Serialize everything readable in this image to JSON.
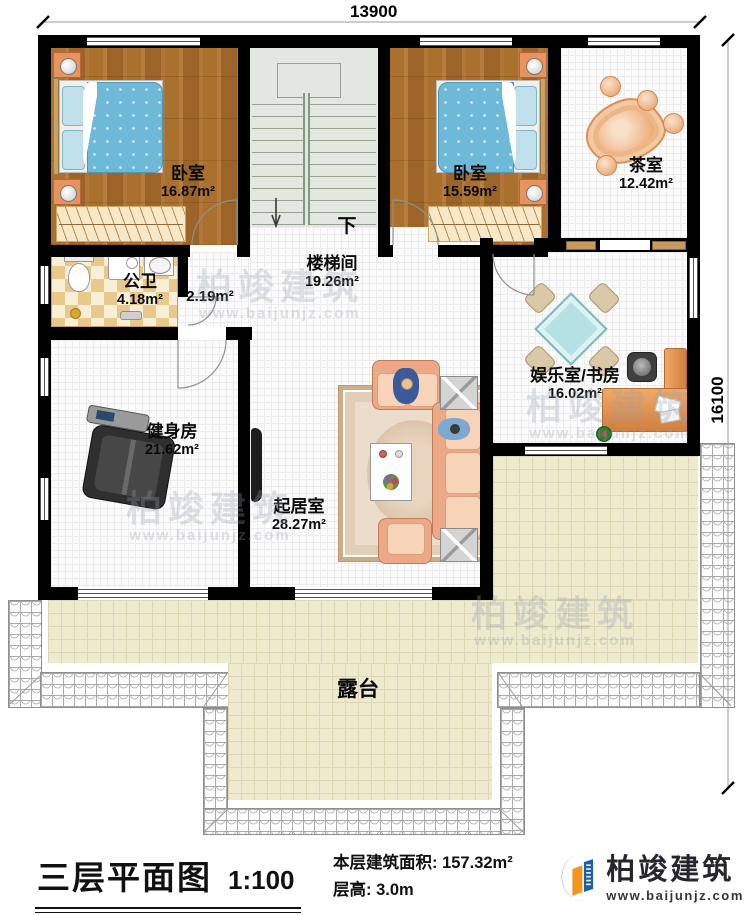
{
  "dimensions": {
    "top_width": "13900",
    "right_height": "16100"
  },
  "rooms": {
    "bedroom_left": {
      "name": "卧室",
      "area": "16.87m²"
    },
    "bedroom_right": {
      "name": "卧室",
      "area": "15.59m²"
    },
    "tea_room": {
      "name": "茶室",
      "area": "12.42m²"
    },
    "bathroom": {
      "name": "公卫",
      "area": "4.18m²"
    },
    "vestibule": {
      "area": "2.19m²"
    },
    "stair_hall": {
      "name": "楼梯间",
      "area": "19.26m²"
    },
    "entertainment_study": {
      "name": "娱乐室/书房",
      "area": "16.02m²"
    },
    "gym": {
      "name": "健身房",
      "area": "21.62m²"
    },
    "living_room": {
      "name": "起居室",
      "area": "28.27m²"
    },
    "terrace": {
      "name": "露台"
    },
    "stairs": {
      "direction_label": "下"
    }
  },
  "watermark": {
    "brand": "柏竣建筑",
    "website": "www.baijunjz.com"
  },
  "footer": {
    "title": "三层平面图",
    "scale": "1:100",
    "area_line": "本层建筑面积: 157.32m²",
    "height_line": "层高: 3.0m",
    "brand": "柏竣建筑",
    "website": "www.baijunjz.com"
  },
  "colors": {
    "wall": "#000000",
    "wood_floor": "#a9702e",
    "bed_quilt": "#6fb9d8",
    "accent_orange": "#e8935f",
    "sofa": "#eda987",
    "stair_floor": "#e2e8df",
    "terrace_tile": "#edeacd",
    "brand_blue": "#1b61a8",
    "brand_orange": "#f7941d"
  }
}
